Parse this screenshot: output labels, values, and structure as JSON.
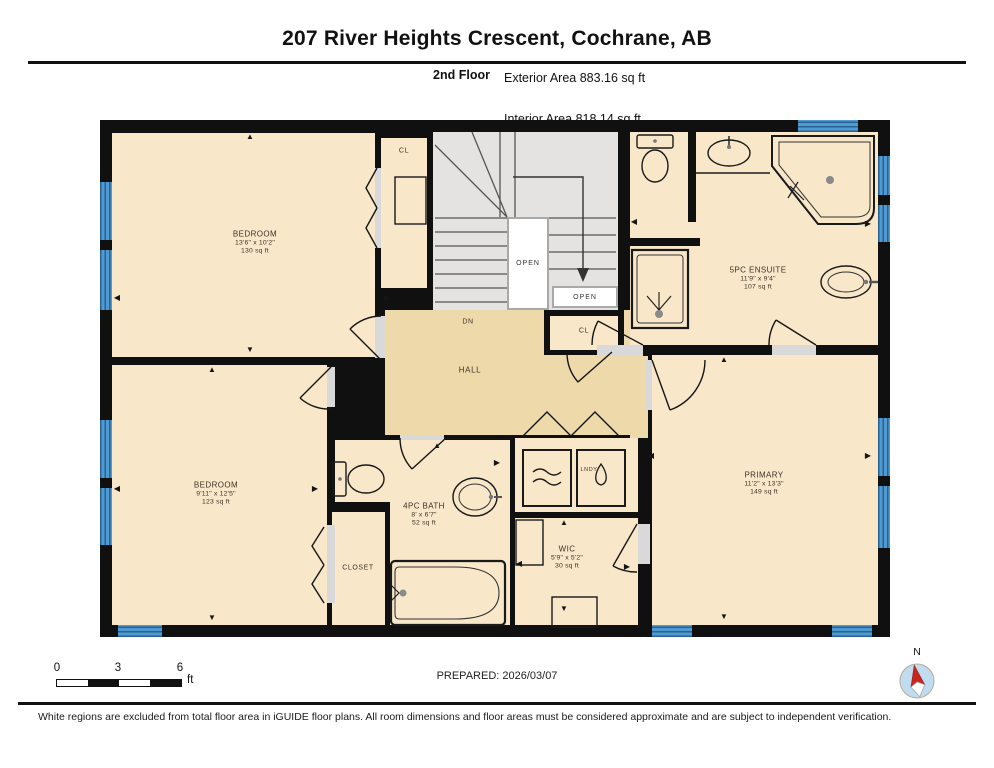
{
  "header": {
    "title": "207 River Heights Crescent, Cochrane, AB",
    "floor_label": "2nd Floor",
    "stat_exterior": "Exterior Area 883.16 sq ft",
    "stat_interior": "Interior Area 818.14 sq ft",
    "stat_excluded": "Excluded Area 7.68 sq ft"
  },
  "rooms": [
    {
      "name": "BEDROOM",
      "dims": "13'6\" x 10'2\"",
      "area": "130 sq ft"
    },
    {
      "name": "BEDROOM",
      "dims": "9'11\" x 12'5\"",
      "area": "123 sq ft"
    },
    {
      "name": "5PC ENSUITE",
      "dims": "11'9\" x 9'4\"",
      "area": "107 sq ft"
    },
    {
      "name": "PRIMARY",
      "dims": "11'2\" x 13'3\"",
      "area": "149 sq ft"
    },
    {
      "name": "4PC BATH",
      "dims": "8' x 6'7\"",
      "area": "52 sq ft"
    },
    {
      "name": "WIC",
      "dims": "5'9\" x 5'2\"",
      "area": "30 sq ft"
    }
  ],
  "labels": {
    "hall": "HALL",
    "dn": "DN",
    "closet": "CLOSET",
    "cl_top": "CL",
    "cl_mid": "CL",
    "open_stairwell": "OPEN",
    "open_landing": "OPEN",
    "laundry": "LNDY",
    "north": "N"
  },
  "scale_bar": {
    "tick_0": "0",
    "tick_3": "3",
    "tick_6": "6",
    "unit": "ft"
  },
  "footer": {
    "prepared": "PREPARED: 2026/03/07",
    "disclaimer": "White regions are excluded from total floor area in iGUIDE floor plans. All room dimensions and floor areas must be considered approximate and are subject to independent verification."
  },
  "colors": {
    "wall": "#101010",
    "room_fill": "#f8e7c9",
    "hall_fill": "#eed9ab",
    "stair_fill": "#e4e3e2",
    "window_blue": "#4f9ad2",
    "window_dark": "#2a628f",
    "compass_red": "#c9251f",
    "compass_circle": "#bfdcf0"
  }
}
